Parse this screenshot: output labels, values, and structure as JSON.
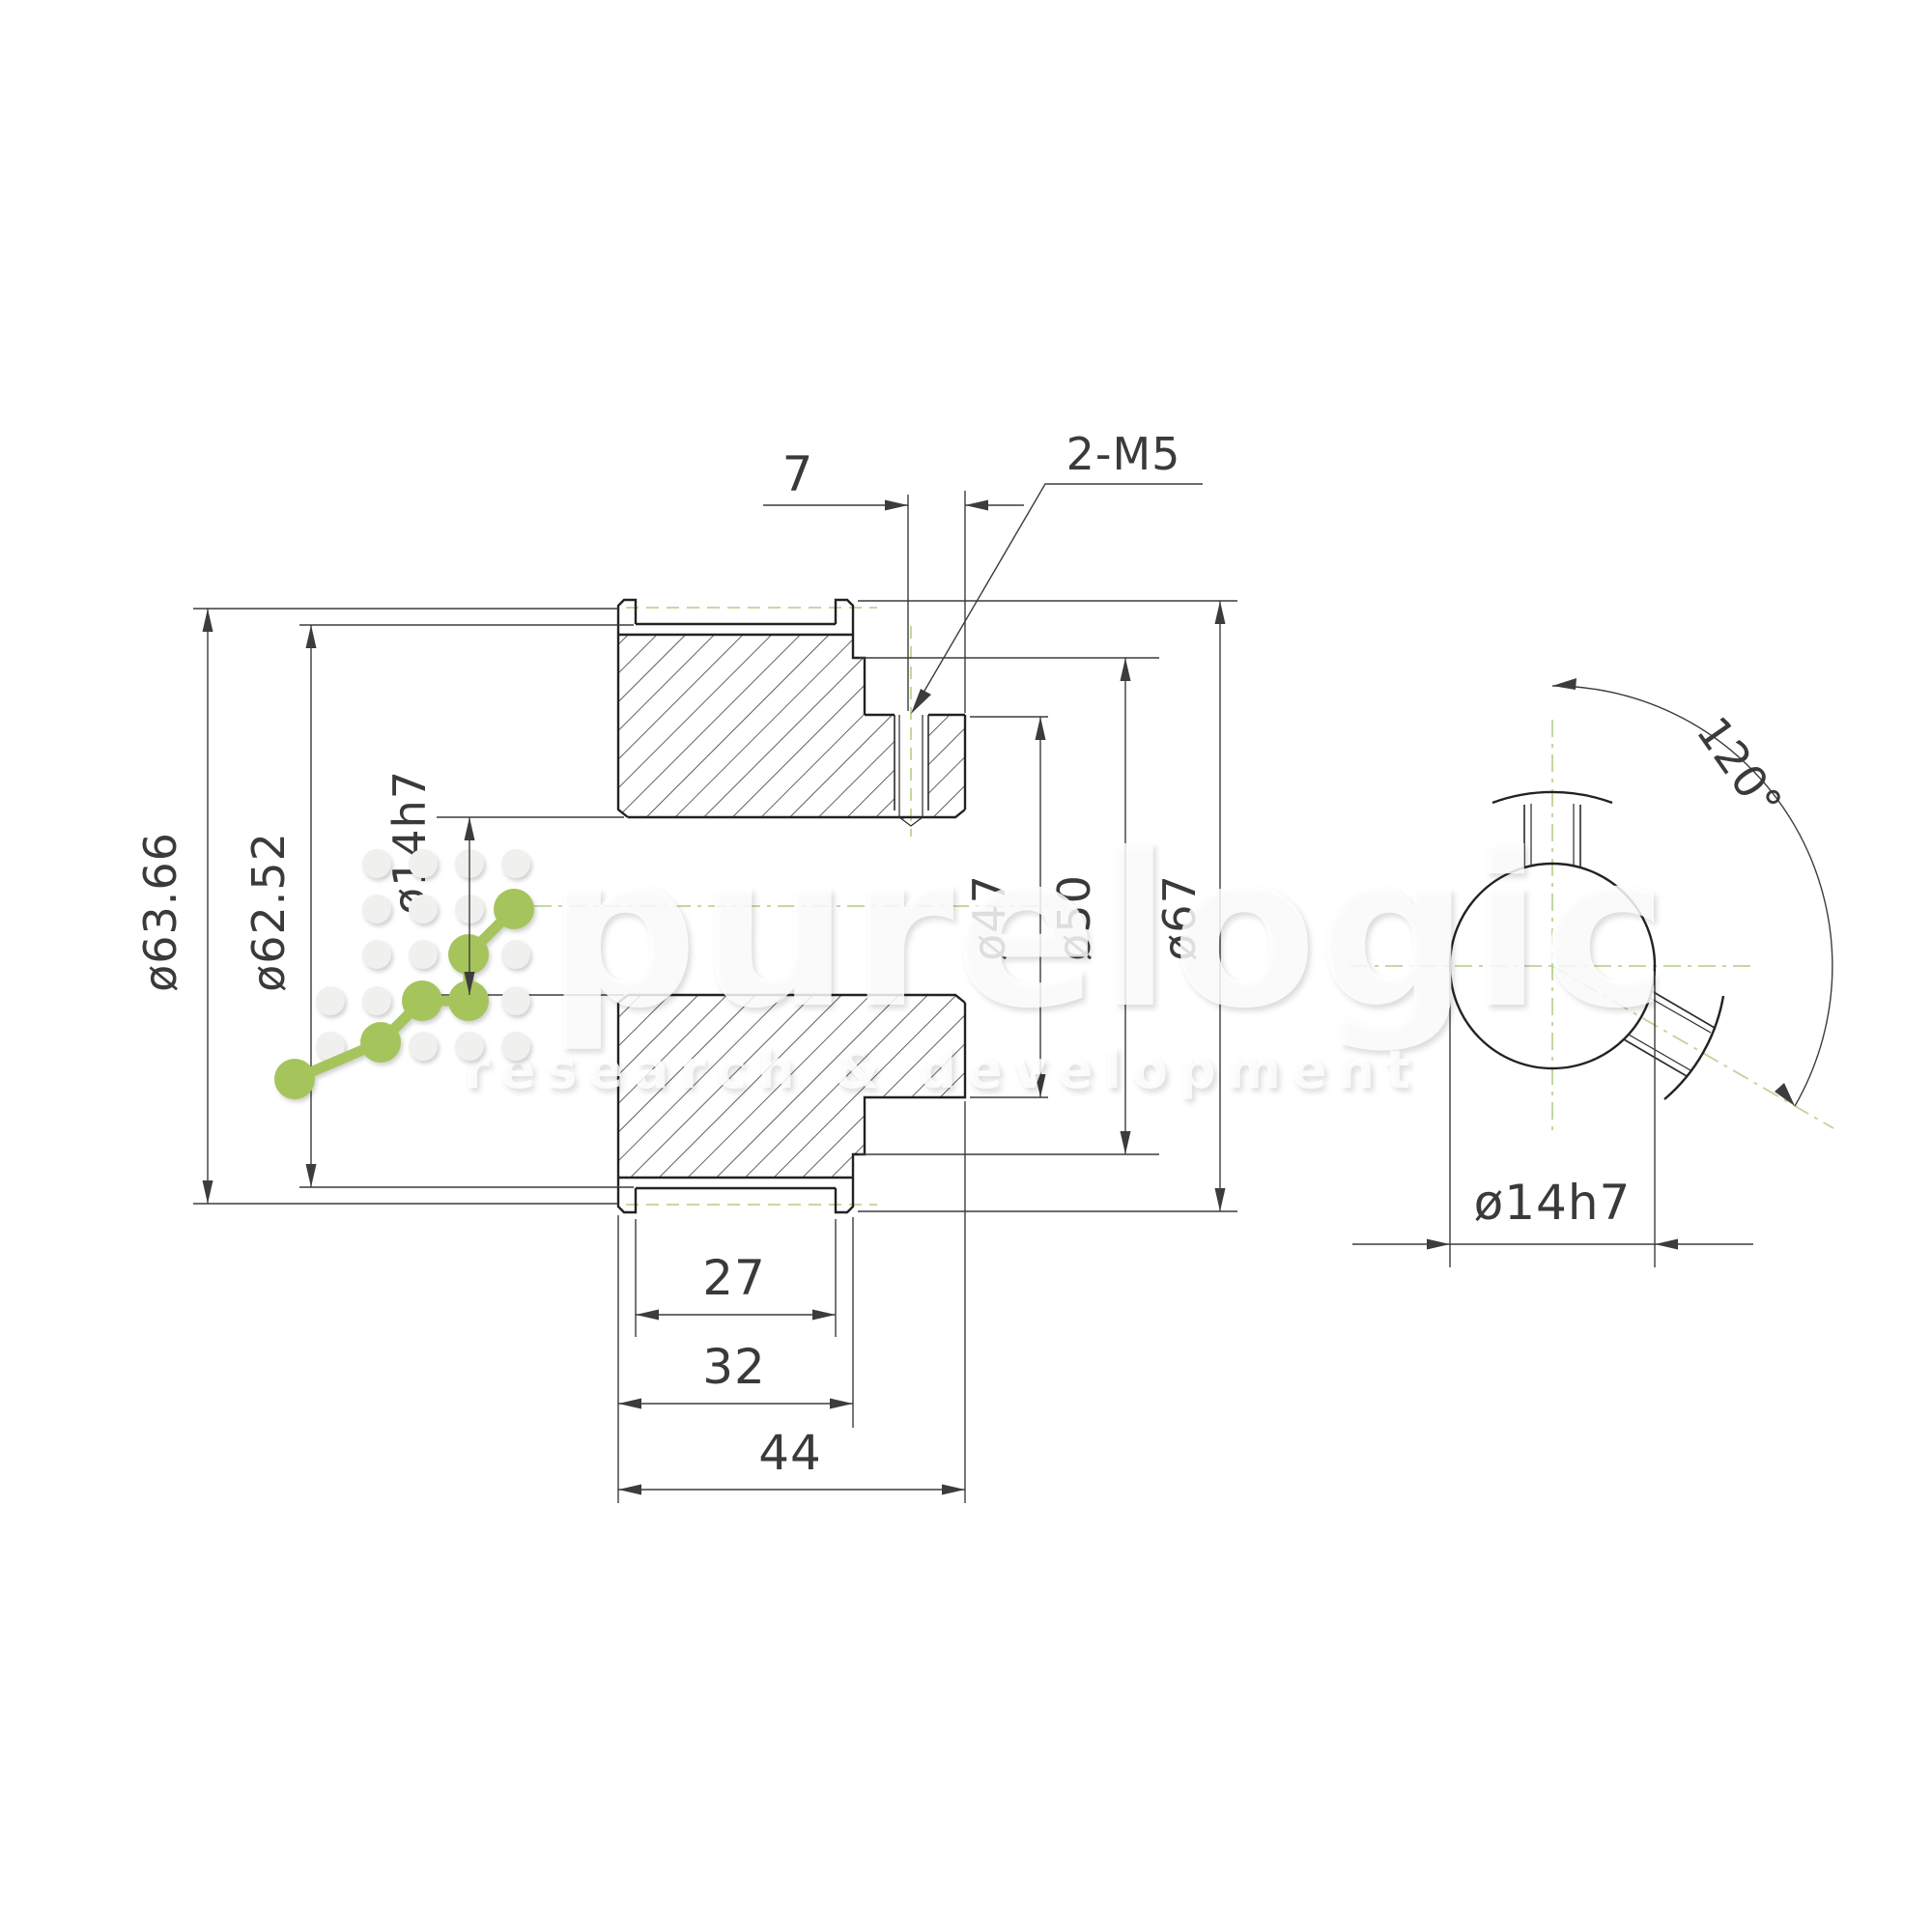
{
  "drawing": {
    "dims": {
      "offset": "7",
      "holes": "2-M5",
      "pitch_diameter": "ø63.66",
      "outside_diameter": "ø62.52",
      "bore": "ø14h7",
      "recess_diameter": "ø47",
      "hub_diameter": "ø50",
      "flange_diameter": "ø67",
      "belt_width": "27",
      "width_over_flanges": "32",
      "total_width": "44",
      "screw_angle": "120°"
    }
  },
  "watermark": {
    "brand": "purelogic",
    "tagline": "research & development"
  },
  "colors": {
    "line": "#222222",
    "dim": "#3c3c3c",
    "green_accent": "#a6c45c",
    "green_dash": "#bcd494"
  }
}
